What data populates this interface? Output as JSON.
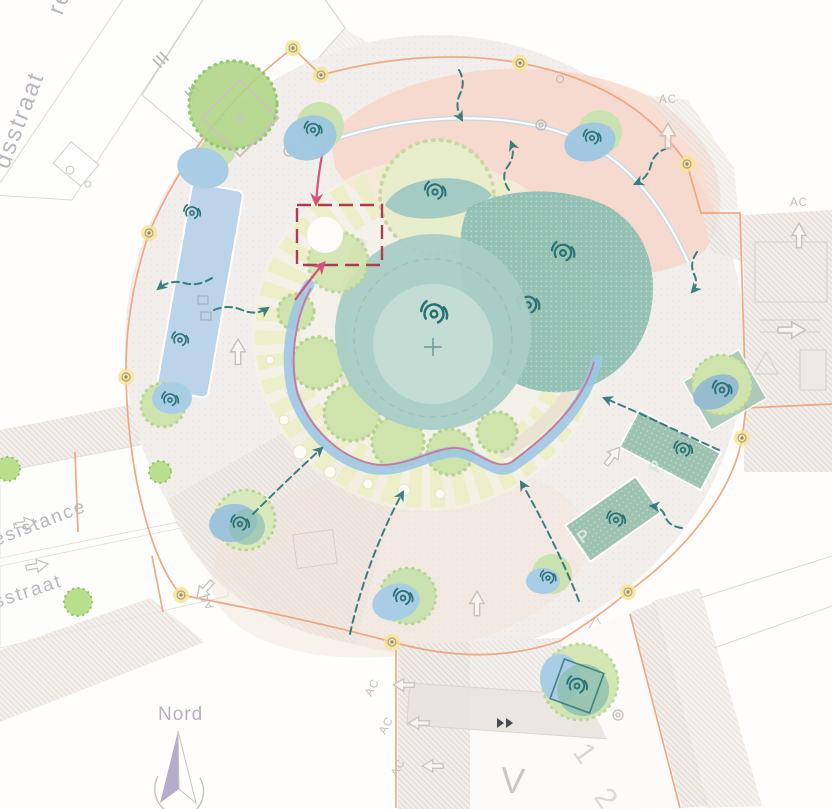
{
  "title": "Roundabout landscape masterplan",
  "labels": {
    "street_top_partial": "re",
    "street_top_left": "dsstraat",
    "street_left_upper": "esistance",
    "street_left_lower": "sstraat",
    "compass_north": "Nord",
    "ac_marker": "AC",
    "road_letter": "V",
    "lane_number_1": "1",
    "lane_number_2": "2",
    "parking_letter": "P"
  },
  "legend_colors": {
    "project_boundary_orange": "#efa077",
    "route_pink": "#d4688e",
    "relocation_red": "#b03a52",
    "view_arrow_teal": "#2a7274",
    "stream_blue": "#9cc6e6",
    "pond_teal": "#a8cec6",
    "dense_planting_teal": "#8fbfb2",
    "planting_bed_green": "#ebeec6",
    "tree_green": "#cfe4ad",
    "existing_tree_green": "#b0d687",
    "pedestrian_zone_salmon": "#f6d3c3",
    "lamp_yellow": "#f7e387",
    "platform_blue": "#b7d2e9",
    "parking_teal": "#9dc2b2"
  }
}
